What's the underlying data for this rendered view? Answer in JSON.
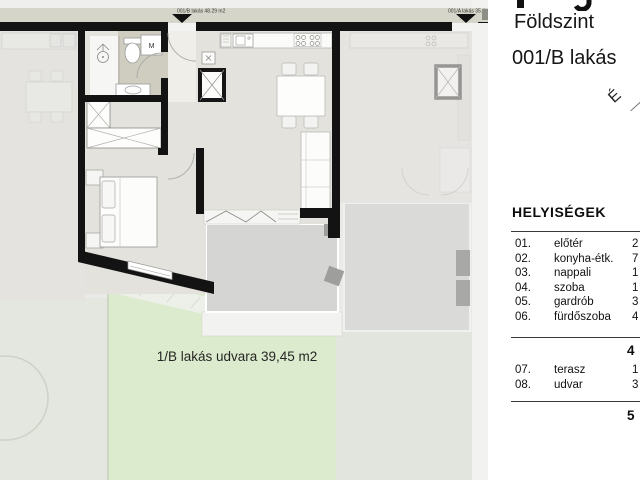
{
  "plan": {
    "entrance_b_label": "001/B lakás 48.29 m2",
    "entrance_a_label": "001/A lakás 35.4",
    "courtyard_label": "1/B lakás udvara 39,45 m2",
    "washing_machine_label": "M",
    "colors": {
      "wall": "#131313",
      "apartment_floor": "#e4e2dc",
      "bathroom_floor": "#cfccc0",
      "terrace_gray": "#d5d5d3",
      "courtyard_green": "#dcebcd",
      "top_band": "#d5d5ca",
      "neighbor_floor": "#e4e3e0"
    }
  },
  "panel": {
    "floor_label": "Földszint",
    "unit_label": "001/B lakás",
    "north_label": "É",
    "rooms_header": "HELYISÉGEK",
    "rooms": [
      {
        "num": "01.",
        "name": "előtér",
        "area_partial": "2"
      },
      {
        "num": "02.",
        "name": "konyha-étk.",
        "area_partial": "7"
      },
      {
        "num": "03.",
        "name": "nappali",
        "area_partial": "1"
      },
      {
        "num": "04.",
        "name": "szoba",
        "area_partial": "1"
      },
      {
        "num": "05.",
        "name": "gardrób",
        "area_partial": "3"
      },
      {
        "num": "06.",
        "name": "fürdőszoba",
        "area_partial": "4"
      }
    ],
    "indoor_total_partial": "4",
    "outdoor_rooms": [
      {
        "num": "07.",
        "name": "terasz",
        "area_partial": "1"
      },
      {
        "num": "08.",
        "name": "udvar",
        "area_partial": "3"
      }
    ],
    "grand_total_partial": "5"
  }
}
